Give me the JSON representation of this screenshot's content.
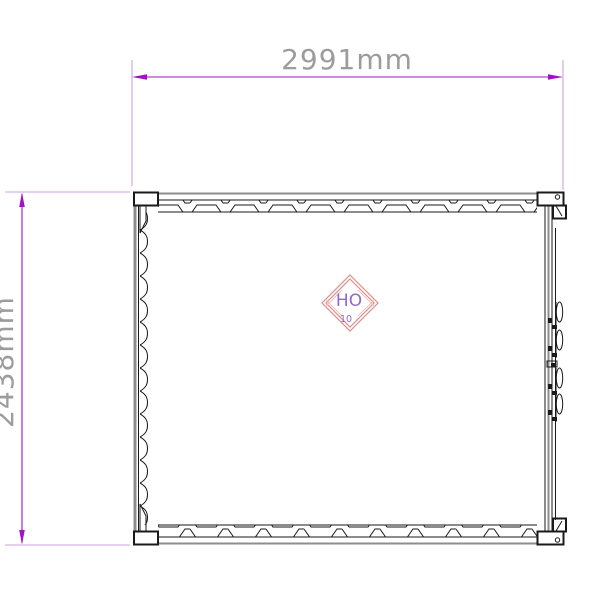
{
  "drawing": {
    "type": "container-plan-technical-drawing",
    "dimensions": {
      "width_label": "2991mm",
      "height_label": "2438mm"
    },
    "logo": {
      "line1": "HO",
      "line2": "10"
    }
  },
  "colors": {
    "dimension_line": "#A112C4",
    "extension_line": "#CDA2DE",
    "dimension_text": "#9C9C9C",
    "drawing_black": "#1A1A1A",
    "drawing_gray": "#8C8C8C",
    "logo_border": "#DC8D86",
    "logo_hatch": "#E8B2AC",
    "logo_text": "#8D6CC0"
  }
}
